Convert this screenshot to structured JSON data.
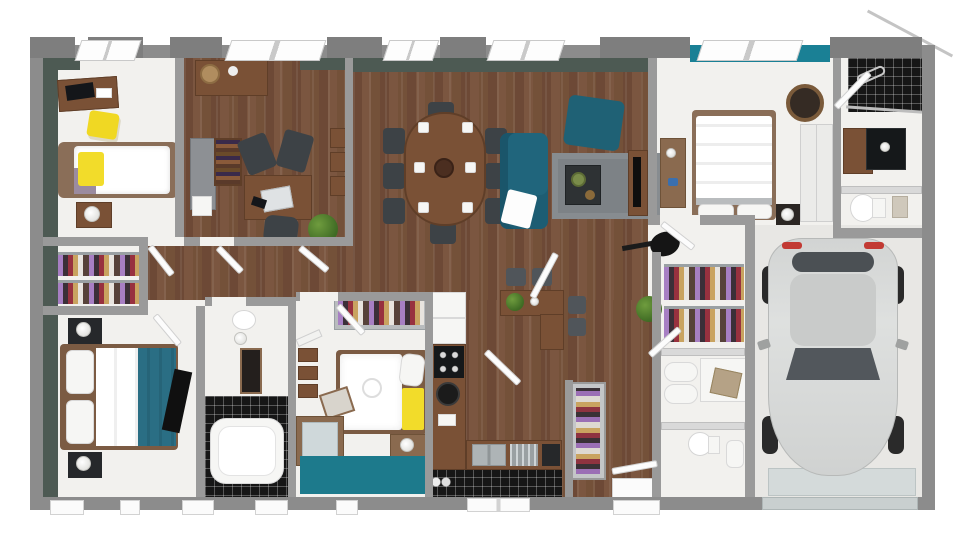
{
  "scene": {
    "kind": "3d-floor-plan-top-view-render",
    "description": "Photorealistic top-down 3D floor plan of a single-storey house with attached single-car garage; no text labels are rendered in the image",
    "background_color": "#ffffff",
    "exterior_wall_color": "#8c8c8c",
    "interior_accent_wall_color": "#4d5a53",
    "wood_floor_color": "#7a553f",
    "accent_teal": "#20657c",
    "accent_teal_wall": "#1a8095",
    "accent_yellow": "#f2dc2a",
    "rug_gray": "#7d8286",
    "black_tile": "#161616",
    "car_color": "#d5d7d6"
  },
  "rooms": [
    {
      "name": "bedroom-1",
      "position": "top-left",
      "floor": "white",
      "furniture": [
        "wood-desk",
        "laptop",
        "yellow-chair",
        "double-bed-white-duvet-yellow-pillow",
        "nightstand",
        "white-lamp"
      ]
    },
    {
      "name": "office",
      "position": "top-center-left",
      "floor": "wood",
      "furniture": [
        "console-table",
        "gray-cabinet",
        "printer",
        "bookshelf",
        "work-desk",
        "laptop",
        "black-guest-chair",
        "black-guest-chair",
        "office-chair",
        "potted-plant",
        "wall-shelves"
      ]
    },
    {
      "name": "dining-living-room",
      "position": "top-center",
      "floor": "wood",
      "furniture": [
        "oval-dining-table",
        "eight-dark-chairs",
        "place-settings",
        "teal-sofa",
        "white-throw",
        "teal-ottoman",
        "gray-rug",
        "dark-coffee-table",
        "tv-stand",
        "television",
        "acoustic-guitar",
        "breakfast-island",
        "island-stools",
        "potted-plant"
      ]
    },
    {
      "name": "master-bedroom",
      "position": "top-right",
      "floor": "white",
      "accent": "teal-window-wall",
      "furniture": [
        "double-bed-white-duvet",
        "pillows",
        "dresser",
        "wall-tv",
        "round-lounge-chair",
        "wardrobe",
        "nightstand",
        "lamp"
      ]
    },
    {
      "name": "master-bathroom",
      "position": "top-right-corner",
      "floor": "white",
      "furniture": [
        "black-tile-shower",
        "glass-screen",
        "wood-vanity",
        "black-sink-unit"
      ]
    },
    {
      "name": "master-wc",
      "position": "right",
      "floor": "white",
      "furniture": [
        "toilet",
        "towel"
      ]
    },
    {
      "name": "walk-in-closet",
      "position": "left",
      "floor": "white",
      "furniture": [
        "two-clothes-racks"
      ]
    },
    {
      "name": "bedroom-2",
      "position": "bottom-left",
      "floor": "white",
      "furniture": [
        "double-bed-teal-throw",
        "pillows",
        "nightstand-with-black-lamp",
        "nightstand-with-black-lamp",
        "wall-tv"
      ]
    },
    {
      "name": "bathroom",
      "position": "bottom-center-left",
      "floor": "white-and-black-tile",
      "furniture": [
        "toilet",
        "mirror-cabinet",
        "bathtub"
      ]
    },
    {
      "name": "bedroom-3",
      "position": "bottom-center",
      "floor": "white",
      "furniture": [
        "open-wardrobe",
        "wall-shelves",
        "electric-guitar",
        "single-bed-yellow-blanket",
        "round-cushion",
        "nightstand",
        "glass-desk",
        "chair",
        "teal-rug"
      ]
    },
    {
      "name": "kitchen",
      "position": "bottom-center",
      "floor": "wood-and-black-tile",
      "furniture": [
        "fridge",
        "cooktop",
        "l-shaped-counter",
        "round-basin",
        "double-sink",
        "dish-rack",
        "coffee-machine",
        "bottles"
      ]
    },
    {
      "name": "hallway",
      "position": "center",
      "floor": "wood",
      "furniture": [
        "open-doors"
      ]
    },
    {
      "name": "entry",
      "position": "bottom-center-right",
      "floor": "wood",
      "furniture": [
        "shoe-cabinet",
        "door-mat",
        "potted-plant"
      ]
    },
    {
      "name": "dressing",
      "position": "center-right",
      "floor": "white",
      "furniture": [
        "two-clothes-racks"
      ]
    },
    {
      "name": "laundry",
      "position": "center-right",
      "floor": "white",
      "furniture": [
        "washing-machine",
        "laundry-basket",
        "laundry-bin"
      ]
    },
    {
      "name": "wc",
      "position": "bottom-center-right",
      "floor": "white",
      "furniture": [
        "toilet",
        "hand-basin"
      ]
    },
    {
      "name": "garage",
      "position": "right",
      "floor": "concrete",
      "furniture": [
        "silver-hatchback-car",
        "garage-door"
      ]
    }
  ]
}
